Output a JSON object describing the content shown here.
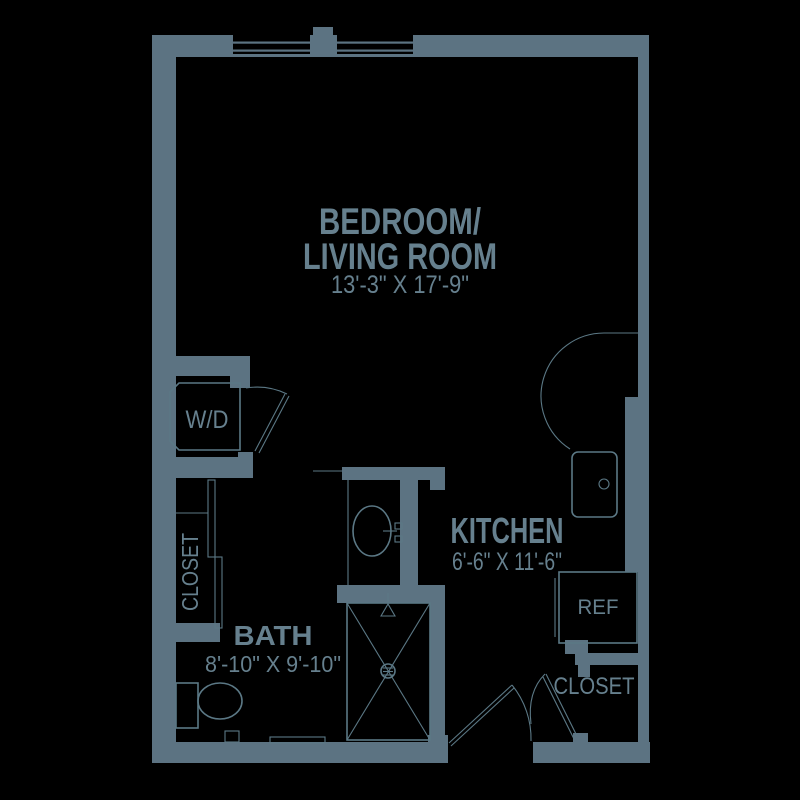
{
  "palette": {
    "background": "#000000",
    "wall": "#5c7382",
    "line": "#5b7885",
    "text": "#66808e"
  },
  "plan": {
    "type": "studio-apartment-floor-plan"
  },
  "rooms": {
    "living": {
      "name_line1": "BEDROOM/",
      "name_line2": "LIVING ROOM",
      "dimensions": "13'-3\" X 17'-9\""
    },
    "kitchen": {
      "name": "KITCHEN",
      "dimensions": "6'-6\" X 11'-6\""
    },
    "bath": {
      "name": "BATH",
      "dimensions": "8'-10\" X 9'-10\""
    },
    "closet_left": {
      "name": "CLOSET"
    },
    "closet_entry": {
      "name": "CLOSET"
    }
  },
  "fixtures": {
    "washer_dryer": "W/D",
    "refrigerator": "REF"
  }
}
